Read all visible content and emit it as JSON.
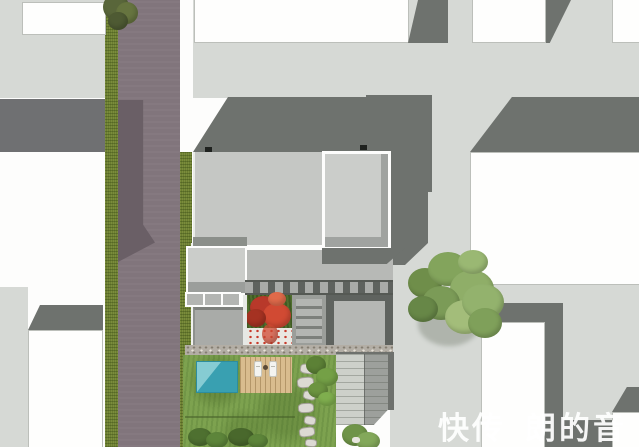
{
  "scene": {
    "type": "architectural-site-plan-render",
    "description": "Top-down rendered site plan of a courtyard house with flat gray roof, two white-outlined roof boxes, inner courtyard with red maple, swimming pool, wood deck, lawn, stepping-stone path and gravel side yard, bounded by an asphalt street with green verges and neighboring white-roofed buildings",
    "watermark": {
      "fragment_left": "快传",
      "fragment_right": "朗的音",
      "color": "#ffffff"
    },
    "labels": {
      "main_house_roof": "main house roof",
      "roof_terrace_box": "white-framed roof box (large)",
      "roof_terrace_box_small": "white-framed roof box (small)",
      "garage_skylights": "garage skylight panels",
      "pergola": "slatted pergola band",
      "courtyard_maple": "red maple courtyard tree",
      "pool": "swimming pool",
      "deck": "wood deck with loungers",
      "lawn": "rear lawn",
      "stepping_stones": "stepping-stone path",
      "gravel_yard": "gravel side yard",
      "street_tree": "street tree",
      "road": "asphalt street",
      "cross_road": "side road",
      "verges": "grass verges",
      "neighbors": "neighboring buildings"
    },
    "colors": {
      "street_light": "#d6d9d5",
      "shadow_dark": "#6e726e",
      "road_asphalt": "#81757c",
      "road_lane_dark": "#6a5f66",
      "cross_road": "#6f7072",
      "verge_green": "#6b7d31",
      "lawn_green": "#7da24f",
      "roof_light": "#c5c7c4",
      "roof_box_outline": "#fdfdfc",
      "pool_teal": "#39a0b1",
      "deck_wood": "#d9bc8e",
      "maple_red": "#c83a2a",
      "canopy_green": "#7b9b57"
    }
  }
}
